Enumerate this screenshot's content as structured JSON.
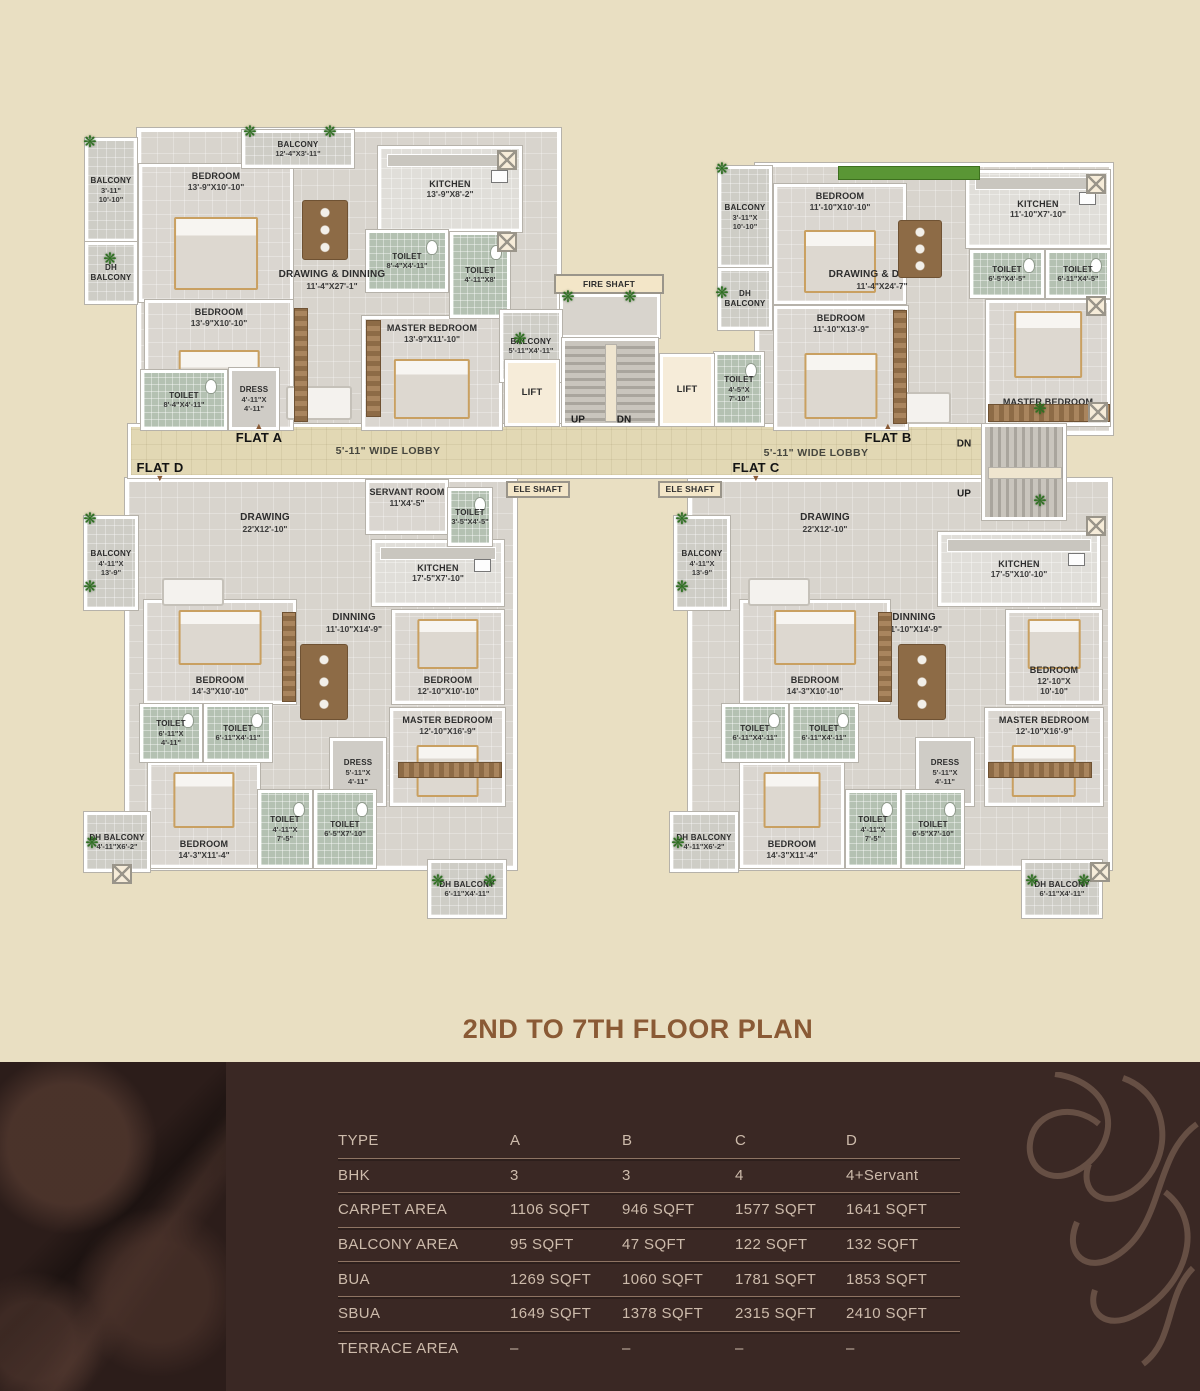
{
  "title": "2ND  TO 7TH FLOOR PLAN",
  "colors": {
    "background": "#e9dfc2",
    "footer": "#3a2824",
    "accent_brown": "#8a5a35",
    "table_text": "#cdbbab",
    "table_line": "#8e7463",
    "toilet_tile": "#b4c1b2",
    "floor": "#d8d4cd",
    "lobby": "#e2d8b4",
    "wall": "#ffffff",
    "plant_green": "#2f7022"
  },
  "plan": {
    "rooms": [
      {
        "k": "flatbg",
        "b": [
          137,
          128,
          424,
          302
        ]
      },
      {
        "k": "flatbg",
        "b": [
          755,
          163,
          358,
          272
        ]
      },
      {
        "k": "flatbg",
        "b": [
          125,
          478,
          392,
          392
        ]
      },
      {
        "k": "flatbg",
        "b": [
          688,
          478,
          424,
          392
        ]
      },
      {
        "k": "lobby",
        "b": [
          128,
          424,
          938,
          54
        ]
      },
      {
        "k": "bedroom",
        "n": "BEDROOM",
        "d": "13'-9\"X10'-10\"",
        "b": [
          139,
          164,
          154,
          138
        ],
        "lp": "top"
      },
      {
        "k": "bedroom",
        "n": "BEDROOM",
        "d": "13'-9\"X10'-10\"",
        "b": [
          145,
          300,
          148,
          130
        ],
        "lp": "top"
      },
      {
        "k": "bedroom",
        "n": "MASTER BEDROOM",
        "d": "13'-9\"X11'-10\"",
        "b": [
          362,
          316,
          140,
          114
        ],
        "lp": "top"
      },
      {
        "k": "kitchen",
        "n": "KITCHEN",
        "d": "13'-9\"X8'-2\"",
        "b": [
          378,
          146,
          144,
          86
        ]
      },
      {
        "k": "bedroom",
        "n": "BEDROOM",
        "d": "11'-10\"X10'-10\"",
        "b": [
          774,
          184,
          132,
          120
        ],
        "lp": "top"
      },
      {
        "k": "bedroom",
        "n": "BEDROOM",
        "d": "11'-10\"X13'-9\"",
        "b": [
          774,
          306,
          134,
          124
        ],
        "lp": "top"
      },
      {
        "k": "bedroom",
        "n": "MASTER BEDROOM",
        "d": "11'-10\"X13'-9\"",
        "b": [
          986,
          300,
          124,
          126
        ],
        "lp": "bottom"
      },
      {
        "k": "kitchen",
        "n": "KITCHEN",
        "d": "11'-10\"X7'-10\"",
        "b": [
          966,
          170,
          144,
          78
        ]
      },
      {
        "k": "roomplain",
        "n": "SERVANT ROOM",
        "d": "11'X4'-5\"",
        "b": [
          366,
          480,
          82,
          54
        ],
        "lp": "top"
      },
      {
        "k": "kitchen",
        "n": "KITCHEN",
        "d": "17'-5\"X7'-10\"",
        "b": [
          372,
          540,
          132,
          66
        ]
      },
      {
        "k": "bedroom",
        "n": "BEDROOM",
        "d": "14'-3\"X10'-10\"",
        "b": [
          144,
          600,
          152,
          104
        ],
        "lp": "bottom"
      },
      {
        "k": "bedroom",
        "n": "BEDROOM",
        "d": "12'-10\"X10'-10\"",
        "b": [
          392,
          610,
          112,
          94
        ],
        "lp": "bottom"
      },
      {
        "k": "bedroom",
        "n": "MASTER BEDROOM",
        "d": "12'-10\"X16'-9\"",
        "b": [
          390,
          708,
          115,
          98
        ],
        "lp": "top"
      },
      {
        "k": "bedroom",
        "n": "BEDROOM",
        "d": "14'-3\"X11'-4\"",
        "b": [
          148,
          762,
          112,
          106
        ],
        "lp": "bottom"
      },
      {
        "k": "kitchen",
        "n": "KITCHEN",
        "d": "17'-5\"X10'-10\"",
        "b": [
          938,
          532,
          162,
          74
        ]
      },
      {
        "k": "bedroom",
        "n": "BEDROOM",
        "d": "14'-3\"X10'-10\"",
        "b": [
          740,
          600,
          150,
          104
        ],
        "lp": "bottom"
      },
      {
        "k": "bedroom",
        "n": "BEDROOM",
        "d": "12'-10\"X\n10'-10\"",
        "b": [
          1006,
          610,
          96,
          94
        ],
        "lp": "bottom"
      },
      {
        "k": "bedroom",
        "n": "MASTER BEDROOM",
        "d": "12'-10\"X16'-9\"",
        "b": [
          985,
          708,
          118,
          98
        ],
        "lp": "top"
      },
      {
        "k": "bedroom",
        "n": "BEDROOM",
        "d": "14'-3\"X11'-4\"",
        "b": [
          740,
          762,
          104,
          106
        ],
        "lp": "bottom"
      },
      {
        "k": "toilet",
        "n": "TOILET",
        "d": "8'-4\"X4'-11\"",
        "b": [
          366,
          230,
          82,
          62
        ]
      },
      {
        "k": "toilet",
        "n": "TOILET",
        "d": "4'-11\"X8'",
        "b": [
          450,
          232,
          60,
          86
        ]
      },
      {
        "k": "toilet",
        "n": "TOILET",
        "d": "8'-4\"X4'-11\"",
        "b": [
          141,
          370,
          86,
          60
        ]
      },
      {
        "k": "dress",
        "n": "DRESS",
        "d": "4'-11\"X\n4'-11\"",
        "b": [
          229,
          368,
          50,
          62
        ]
      },
      {
        "k": "balcony",
        "n": "BALCONY",
        "d": "12'-4\"X3'-11\"",
        "b": [
          242,
          130,
          112,
          38
        ]
      },
      {
        "k": "balcony",
        "n": "BALCONY",
        "d": "3'-11\"\n10'-10\"",
        "b": [
          85,
          138,
          52,
          104
        ]
      },
      {
        "k": "balcony",
        "n": "DH BALCONY",
        "d": "",
        "b": [
          85,
          242,
          52,
          62
        ]
      },
      {
        "k": "balcony",
        "n": "BALCONY",
        "d": "5'-11\"X4'-11\"",
        "b": [
          500,
          310,
          62,
          72
        ]
      },
      {
        "k": "balcony",
        "n": "BALCONY",
        "d": "3'-11\"X\n10'-10\"",
        "b": [
          718,
          166,
          54,
          102
        ]
      },
      {
        "k": "balcony",
        "n": "DH BALCONY",
        "d": "",
        "b": [
          718,
          268,
          54,
          62
        ]
      },
      {
        "k": "toilet",
        "n": "TOILET",
        "d": "6'-5\"X4'-5\"",
        "b": [
          970,
          250,
          74,
          48
        ]
      },
      {
        "k": "toilet",
        "n": "TOILET",
        "d": "6'-11\"X4'-5\"",
        "b": [
          1046,
          250,
          64,
          48
        ]
      },
      {
        "k": "toilet",
        "n": "TOILET",
        "d": "4'-5\"X\n7'-10\"",
        "b": [
          714,
          352,
          50,
          74
        ]
      },
      {
        "k": "shaft",
        "b": [
          560,
          294,
          100,
          44
        ]
      },
      {
        "k": "stairs-v",
        "b": [
          562,
          338,
          96,
          88
        ]
      },
      {
        "k": "stairs-h",
        "b": [
          982,
          424,
          84,
          96
        ]
      },
      {
        "k": "lift",
        "n": "LIFT",
        "d": "",
        "b": [
          505,
          360,
          54,
          66
        ]
      },
      {
        "k": "lift",
        "n": "LIFT",
        "d": "",
        "b": [
          660,
          354,
          54,
          72
        ]
      },
      {
        "k": "balcony",
        "n": "BALCONY",
        "d": "4'-11\"X\n13'-9\"",
        "b": [
          84,
          516,
          54,
          94
        ]
      },
      {
        "k": "toilet",
        "n": "TOILET",
        "d": "3'-5\"X4'-5\"",
        "b": [
          448,
          488,
          44,
          58
        ]
      },
      {
        "k": "toilet",
        "n": "TOILET",
        "d": "6'-11\"X\n4'-11\"",
        "b": [
          140,
          704,
          62,
          58
        ]
      },
      {
        "k": "toilet",
        "n": "TOILET",
        "d": "6'-11\"X4'-11\"",
        "b": [
          204,
          704,
          68,
          58
        ]
      },
      {
        "k": "dress",
        "n": "DRESS",
        "d": "5'-11\"X\n4'-11\"",
        "b": [
          330,
          738,
          56,
          68
        ]
      },
      {
        "k": "toilet",
        "n": "TOILET",
        "d": "4'-11\"X\n7'-5\"",
        "b": [
          258,
          790,
          54,
          78
        ]
      },
      {
        "k": "toilet",
        "n": "TOILET",
        "d": "6'-5\"X7'-10\"",
        "b": [
          314,
          790,
          62,
          78
        ]
      },
      {
        "k": "balcony",
        "n": "DH BALCONY",
        "d": "4'-11\"X6'-2\"",
        "b": [
          84,
          812,
          66,
          60
        ]
      },
      {
        "k": "balcony",
        "n": "DH BALCONY",
        "d": "6'-11\"X4'-11\"",
        "b": [
          428,
          860,
          78,
          58
        ]
      },
      {
        "k": "balcony",
        "n": "BALCONY",
        "d": "4'-11\"X\n13'-9\"",
        "b": [
          674,
          516,
          56,
          94
        ]
      },
      {
        "k": "toilet",
        "n": "TOILET",
        "d": "6'-11\"X4'-11\"",
        "b": [
          722,
          704,
          66,
          58
        ]
      },
      {
        "k": "toilet",
        "n": "TOILET",
        "d": "6'-11\"X4'-11\"",
        "b": [
          790,
          704,
          68,
          58
        ]
      },
      {
        "k": "dress",
        "n": "DRESS",
        "d": "5'-11\"X\n4'-11\"",
        "b": [
          916,
          738,
          58,
          68
        ]
      },
      {
        "k": "toilet",
        "n": "TOILET",
        "d": "4'-11\"X\n7'-5\"",
        "b": [
          846,
          790,
          54,
          78
        ]
      },
      {
        "k": "toilet",
        "n": "TOILET",
        "d": "6'-5\"X7'-10\"",
        "b": [
          902,
          790,
          62,
          78
        ]
      },
      {
        "k": "balcony",
        "n": "DH BALCONY",
        "d": "4'-11\"X6'-2\"",
        "b": [
          670,
          812,
          68,
          60
        ]
      },
      {
        "k": "balcony",
        "n": "DH BALCONY",
        "d": "6'-11\"X4'-11\"",
        "b": [
          1022,
          860,
          80,
          58
        ]
      },
      {
        "k": "label",
        "n": "DRAWING & DINNING",
        "d": "11'-4\"X27'-1\"",
        "b": [
          252,
          258,
          160,
          44
        ]
      },
      {
        "k": "label",
        "n": "DRAWING & DINNING",
        "d": "11'-4\"X24'-7\"",
        "b": [
          802,
          258,
          160,
          44
        ]
      },
      {
        "k": "label",
        "n": "DRAWING",
        "d": "22'X12'-10\"",
        "b": [
          185,
          505,
          160,
          36
        ]
      },
      {
        "k": "label",
        "n": "DRAWING",
        "d": "22'X12'-10\"",
        "b": [
          745,
          505,
          160,
          36
        ]
      },
      {
        "k": "label",
        "n": "DINNING",
        "d": "11'-10\"X14'-9\"",
        "b": [
          288,
          606,
          132,
          34
        ]
      },
      {
        "k": "label",
        "n": "DINNING",
        "d": "11'-10\"X14'-9\"",
        "b": [
          848,
          606,
          132,
          34
        ]
      },
      {
        "k": "shaftlabel",
        "n": "FIRE SHAFT",
        "d": "",
        "b": [
          554,
          274,
          110,
          20
        ]
      },
      {
        "k": "shaftlabel",
        "n": "ELE SHAFT",
        "d": "",
        "b": [
          506,
          481,
          64,
          17
        ]
      },
      {
        "k": "shaftlabel",
        "n": "ELE SHAFT",
        "d": "",
        "b": [
          658,
          481,
          64,
          17
        ]
      }
    ],
    "flat_labels": [
      {
        "label": "FLAT A",
        "x": 259,
        "y": 434,
        "marker": "top"
      },
      {
        "label": "FLAT B",
        "x": 888,
        "y": 434,
        "marker": "top"
      },
      {
        "label": "FLAT C",
        "x": 756,
        "y": 471,
        "marker": "bottom"
      },
      {
        "label": "FLAT D",
        "x": 160,
        "y": 471,
        "marker": "bottom"
      }
    ],
    "direction_labels": [
      {
        "t": "UP",
        "x": 578,
        "y": 420
      },
      {
        "t": "DN",
        "x": 624,
        "y": 420
      },
      {
        "t": "DN",
        "x": 964,
        "y": 444
      },
      {
        "t": "UP",
        "x": 964,
        "y": 494
      }
    ],
    "lobby_labels": [
      {
        "t": "5'-11\" WIDE LOBBY",
        "x": 388,
        "y": 451
      },
      {
        "t": "5'-11\" WIDE LOBBY",
        "x": 816,
        "y": 453
      }
    ],
    "decor": {
      "plants": [
        [
          90,
          143
        ],
        [
          110,
          260
        ],
        [
          250,
          133
        ],
        [
          330,
          133
        ],
        [
          568,
          298
        ],
        [
          630,
          298
        ],
        [
          520,
          340
        ],
        [
          722,
          170
        ],
        [
          722,
          294
        ],
        [
          90,
          520
        ],
        [
          90,
          588
        ],
        [
          682,
          520
        ],
        [
          682,
          588
        ],
        [
          92,
          844
        ],
        [
          438,
          882
        ],
        [
          490,
          882
        ],
        [
          678,
          844
        ],
        [
          1032,
          882
        ],
        [
          1084,
          882
        ],
        [
          1040,
          410
        ],
        [
          1040,
          502
        ]
      ],
      "xboxes": [
        [
          497,
          150
        ],
        [
          497,
          232
        ],
        [
          1086,
          174
        ],
        [
          1086,
          296
        ],
        [
          1088,
          402
        ],
        [
          1086,
          516
        ],
        [
          112,
          864
        ],
        [
          1090,
          862
        ]
      ],
      "sofas": [
        [
          286,
          386,
          62,
          30
        ],
        [
          895,
          392,
          52,
          28
        ],
        [
          162,
          578,
          58,
          24
        ],
        [
          748,
          578,
          58,
          24
        ]
      ],
      "tables": [
        [
          302,
          200,
          44,
          58
        ],
        [
          898,
          220,
          42,
          56
        ],
        [
          300,
          644,
          46,
          74
        ],
        [
          898,
          644,
          46,
          74
        ]
      ],
      "wardrobes": [
        [
          294,
          308,
          12,
          112
        ],
        [
          366,
          320,
          13,
          95
        ],
        [
          893,
          310,
          12,
          112
        ],
        [
          988,
          404,
          120,
          16
        ],
        [
          282,
          612,
          12,
          88
        ],
        [
          398,
          762,
          102,
          14
        ],
        [
          878,
          612,
          12,
          88
        ],
        [
          988,
          762,
          102,
          14
        ]
      ],
      "planters": [
        [
          838,
          166,
          140,
          12
        ]
      ]
    }
  },
  "table": {
    "rows": [
      {
        "label": "TYPE",
        "values": [
          "A",
          "B",
          "C",
          "D"
        ]
      },
      {
        "label": "BHK",
        "values": [
          "3",
          "3",
          "4",
          "4+Servant"
        ]
      },
      {
        "label": "CARPET AREA",
        "values": [
          "1106 SQFT",
          "946 SQFT",
          "1577 SQFT",
          "1641 SQFT"
        ]
      },
      {
        "label": "BALCONY AREA",
        "values": [
          "95 SQFT",
          "47 SQFT",
          "122 SQFT",
          "132 SQFT"
        ]
      },
      {
        "label": "BUA",
        "values": [
          "1269 SQFT",
          "1060 SQFT",
          "1781 SQFT",
          "1853 SQFT"
        ]
      },
      {
        "label": "SBUA",
        "values": [
          "1649 SQFT",
          "1378 SQFT",
          "2315 SQFT",
          "2410 SQFT"
        ]
      },
      {
        "label": "TERRACE AREA",
        "values": [
          "–",
          "–",
          "–",
          "–"
        ]
      }
    ]
  }
}
